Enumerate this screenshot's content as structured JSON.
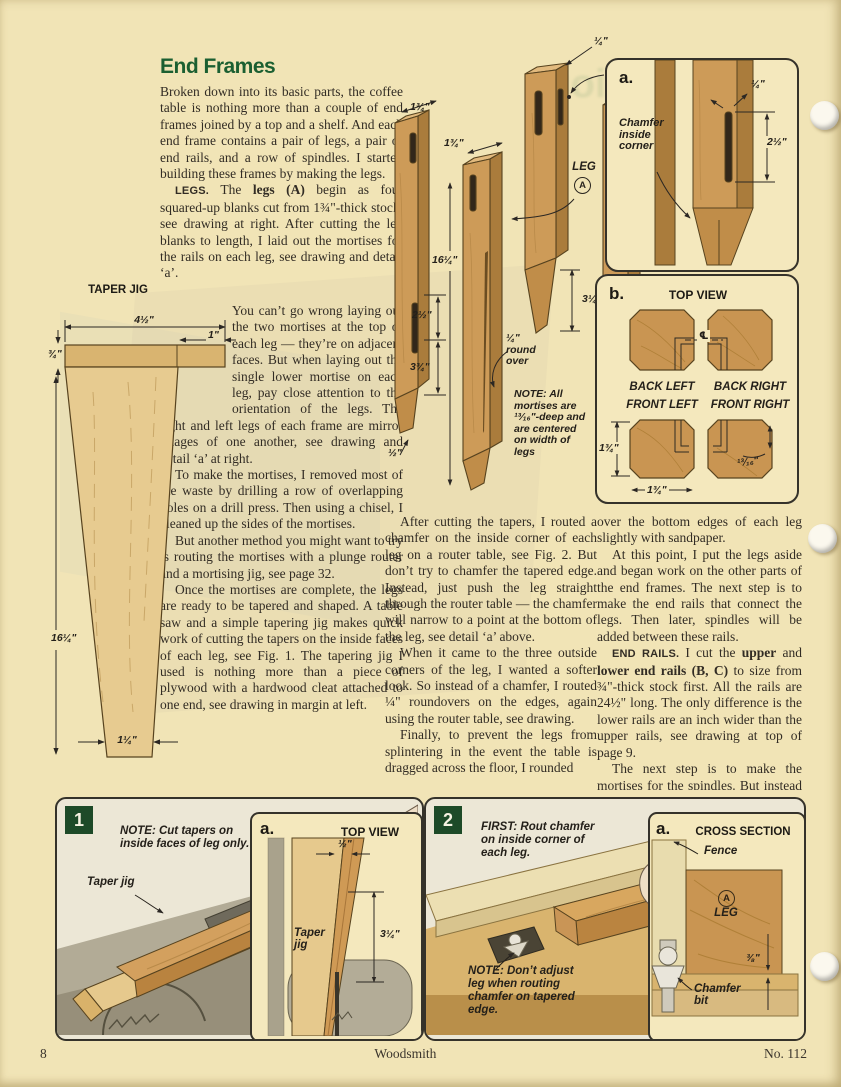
{
  "article": {
    "title": "End Frames",
    "col1_top": [
      {
        "ni": true,
        "runs": [
          {
            "t": "Broken down into its basic parts, the coffee table is nothing more than a couple of end frames joined by a top and a shelf. And each end frame contains a pair of legs, a pair of end rails, and a row of spindles. I started building these frames by making the legs."
          }
        ]
      },
      {
        "runs": [
          {
            "t": "LEGS. ",
            "b": true,
            "c": "lead"
          },
          {
            "t": "The "
          },
          {
            "t": "legs (A)",
            "b": true
          },
          {
            "t": " begin as four squared-up blanks cut from 1¾\"-thick stock, see drawing at right. After cutting the leg blanks to length, I laid out the mortises for the rails on each leg, see drawing and detail ‘a’."
          }
        ]
      }
    ],
    "col1_wrap": [
      {
        "ni": true,
        "runs": [
          {
            "t": "You can’t go wrong laying out the two mortises at the top of each leg — they’re on adjacent faces. But when laying out the single lower mortise on each leg, pay close attention to the orientation of the legs. The right and left legs of each frame are mirror images of one another, see drawing and detail ‘a’ at right."
          }
        ]
      },
      {
        "runs": [
          {
            "t": "To make the mortises, I removed most of the waste by drilling a row of overlapping holes on a drill press. Then using a chisel, I cleaned up the sides of the mortises."
          }
        ]
      },
      {
        "runs": [
          {
            "t": "But another method you might want to try is routing the mortises with a plunge router and a mortising jig, see page 32."
          }
        ]
      },
      {
        "runs": [
          {
            "t": "Once the mortises are complete, the legs are ready to be tapered and shaped. A table saw and a simple tapering jig makes quick work of cutting the tapers on the inside faces of each leg, see Fig. 1. The tapering jig I used is nothing more than a piece of plywood with a hardwood cleat attached to one end, see drawing in margin at left."
          }
        ]
      }
    ],
    "col2": [
      {
        "runs": [
          {
            "t": "After cutting the tapers, I routed a chamfer on the inside corner of each leg on a router table, see Fig. 2. But don’t try to chamfer the tapered edge. Instead, just push the leg straight through the router table — the chamfer will narrow to a point at the bottom of the leg, see detail ‘a’ above."
          }
        ]
      },
      {
        "runs": [
          {
            "t": "When it came to the three outside corners of the leg, I wanted a softer look. So instead of a chamfer, I routed ¼\" roundovers on the edges, again using the router table, see drawing."
          }
        ]
      },
      {
        "runs": [
          {
            "t": "Finally, to prevent the legs from splintering in the event the table is dragged across the floor, I rounded"
          }
        ]
      }
    ],
    "col3": [
      {
        "ni": true,
        "runs": [
          {
            "t": "over the bottom edges of each leg slightly with sandpaper."
          }
        ]
      },
      {
        "runs": [
          {
            "t": "At this point, I put the legs aside and began work on the other parts of the end frames. The next step is to make the end rails that connect the legs. Then later, spindles will be added between these rails."
          }
        ]
      },
      {
        "runs": [
          {
            "t": "END RAILS. ",
            "b": true,
            "c": "lead"
          },
          {
            "t": "I cut the "
          },
          {
            "t": "upper",
            "b": true
          },
          {
            "t": " and "
          },
          {
            "t": "lower end rails (B, C)",
            "b": true
          },
          {
            "t": " to size from ¾\"-thick stock first. All the rails are 24½\" long. The only difference is the lower rails are an inch wider than the upper rails, see drawing at top of page 9."
          }
        ]
      },
      {
        "runs": [
          {
            "t": "The next step is to make the mortises for the spindles. But instead of"
          }
        ]
      }
    ]
  },
  "taper_jig": {
    "title": "TAPER JIG",
    "dim_width": "4½\"",
    "dim_offset": "1\"",
    "dim_cleat": "¾\"",
    "dim_length": "16¼\"",
    "dim_foot": "1¼\""
  },
  "legs": {
    "dim_blank_1": "1¾\"",
    "dim_blank_2": "1¾\"",
    "dim_mortise_inset": "¼\"",
    "dim_top": "1½\"",
    "dim_length": "16¼\"",
    "dim_upper_mortise": "2½\"",
    "dim_lower_mortise": "3¾\"",
    "dim_taper": "3¼\"",
    "dim_chamfer_end": "½\"",
    "roundover": "¼\" round over",
    "leg_label": "LEG",
    "leg_letter": "A",
    "note_label": "NOTE:",
    "note_text": " All mortises are ¹³⁄₁₆\"-deep and are centered on width of legs"
  },
  "detail_a": {
    "label": "a.",
    "callout": "Chamfer inside corner",
    "dim_width": "¼\"",
    "dim_length": "2½\""
  },
  "detail_b": {
    "label": "b.",
    "title": "TOP VIEW",
    "centerline": "℄",
    "back_left": "BACK LEFT",
    "back_right": "BACK RIGHT",
    "front_left": "FRONT LEFT",
    "front_right": "FRONT RIGHT",
    "dim_height": "1¾\"",
    "dim_width": "1¾\"",
    "dim_mortise": "¹³⁄₁₆\""
  },
  "fig1": {
    "number": "1",
    "note_label": "NOTE:",
    "note_text": " Cut tapers on inside faces of leg only.",
    "jig_label": "Taper jig",
    "warning": "Keep hands clear of blade",
    "inset": {
      "label": "a.",
      "title": "TOP VIEW",
      "dim_offset": "½\"",
      "jig_label": "Taper jig",
      "dim_taper": "3¼\""
    }
  },
  "fig2": {
    "number": "2",
    "first_label": "FIRST:",
    "first_text": " Rout chamfer on inside corner of each leg.",
    "note_label": "NOTE:",
    "note_text": " Don’t adjust leg when routing chamfer on tapered edge.",
    "inset": {
      "label": "a.",
      "title": "CROSS SECTION",
      "fence": "Fence",
      "leg_letter": "A",
      "leg_label": "LEG",
      "dim_depth": "⅜\"",
      "bit": "Chamfer bit"
    }
  },
  "footer": {
    "page_number": "8",
    "magazine": "Woodsmith",
    "issue": "No. 112"
  },
  "ghost_text": "Construction"
}
